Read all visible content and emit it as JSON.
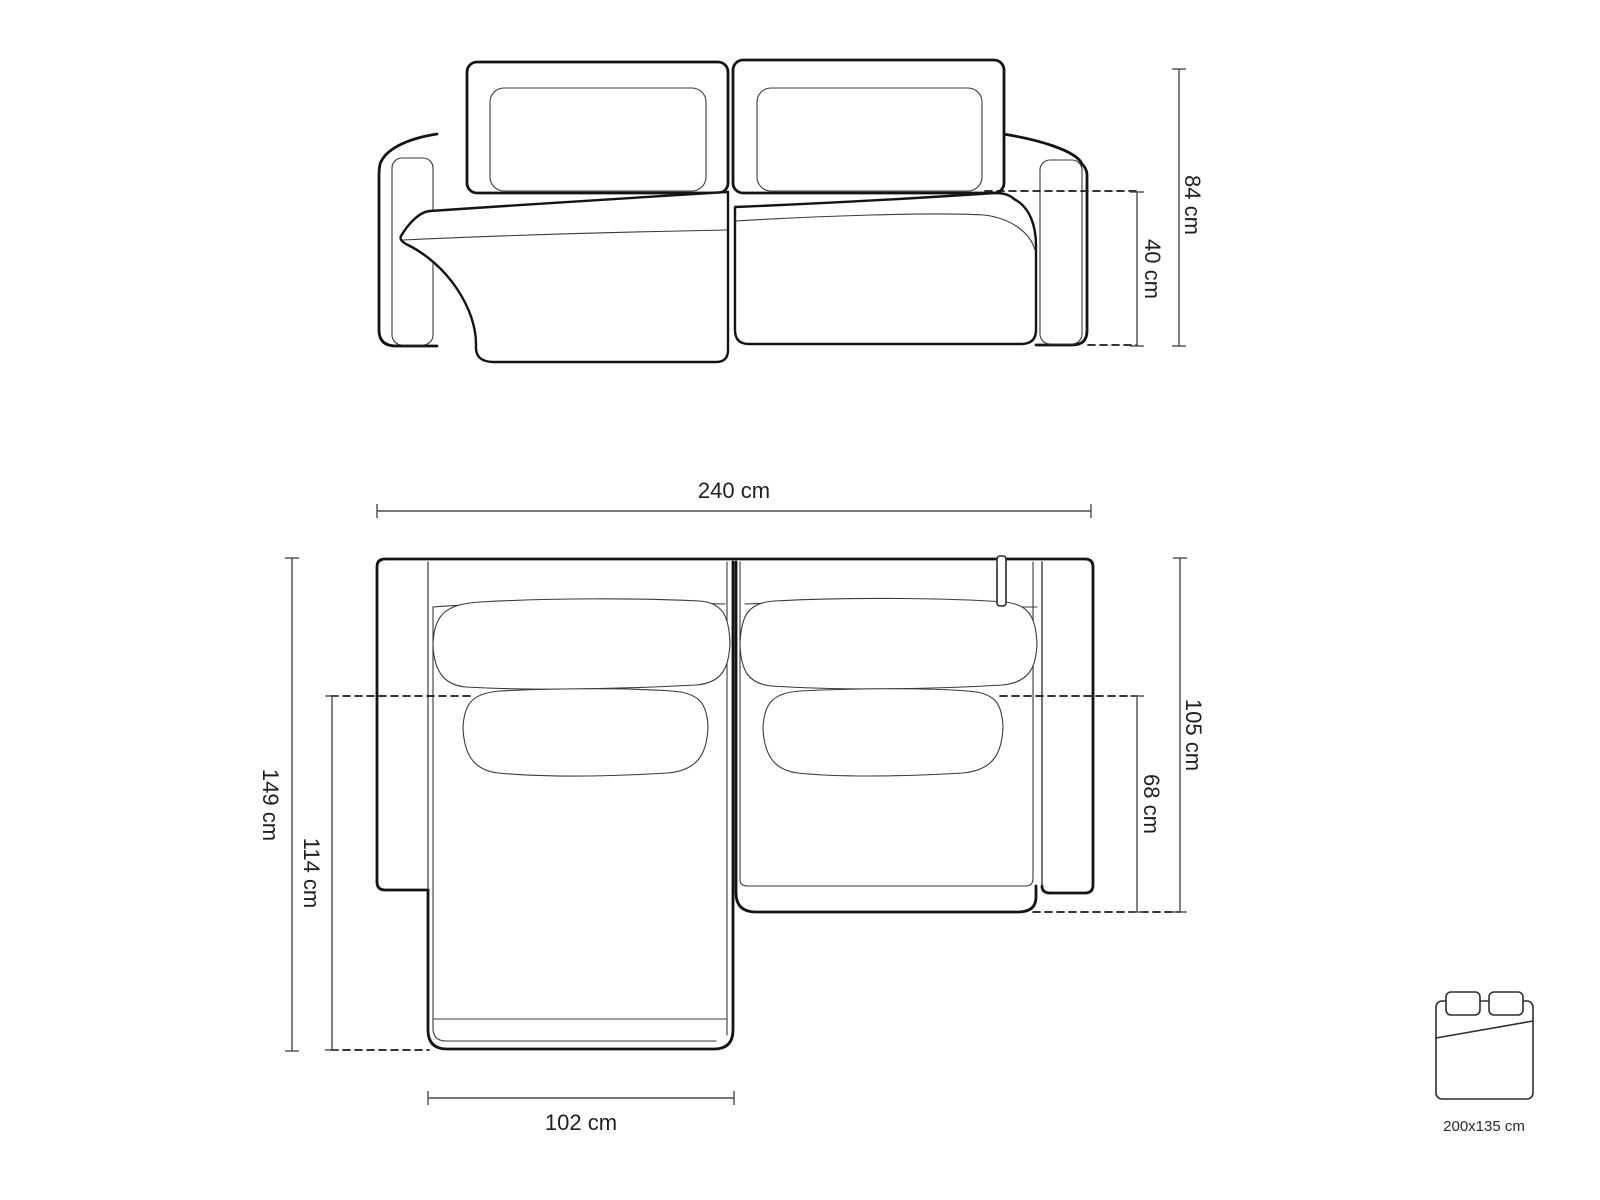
{
  "diagram": {
    "title": "corner-sofa-dimension-drawing",
    "views": [
      "front-elevation",
      "top-plan"
    ],
    "colors": {
      "background": "#ffffff",
      "outline_thick": "#141414",
      "outline_thin": "#3a3a3a",
      "dimension_line": "#4d4d4d",
      "text": "#1f1f1f"
    },
    "dimensions": {
      "front": {
        "total_height_label": "84 cm",
        "seat_height_label": "40 cm"
      },
      "top": {
        "total_width_label": "240 cm",
        "total_depth_label": "149 cm",
        "chaise_depth_label": "114 cm",
        "chaise_width_label": "102 cm",
        "body_depth_label": "105 cm",
        "seat_depth_label": "68 cm"
      }
    },
    "bed_icon": {
      "meaning": "sleeping-function-bed-size",
      "size_label": "200x135 cm"
    }
  }
}
